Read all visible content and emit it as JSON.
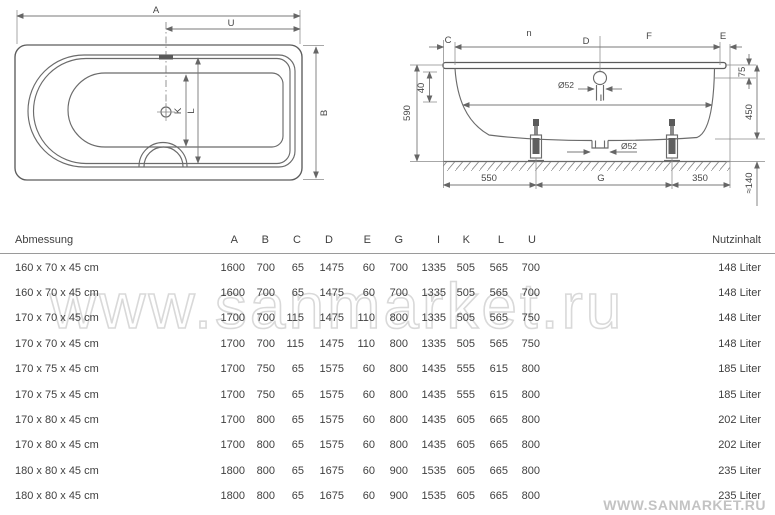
{
  "top_view": {
    "labels": {
      "length": "A",
      "overflow_to_end": "U",
      "width": "B",
      "inner_width": "K",
      "rim_inner_width": "L"
    }
  },
  "side_view": {
    "labels": {
      "left_overhang": "C",
      "upper_left": "n",
      "middle_span": "D",
      "upper_right": "F",
      "right_overhang": "E",
      "inner_length": "I",
      "feet_span": "G"
    },
    "fixed_dims": {
      "total_height": "590",
      "rim_drop": "40",
      "overflow_diameter": "Ø52",
      "drain_diameter": "Ø52",
      "rim_to_overflow": "75",
      "tub_depth": "450",
      "feet_height": "≈140",
      "foot_left_offset": "550",
      "foot_right_offset": "350"
    }
  },
  "table": {
    "header": {
      "dimension": "Abmessung",
      "capacity": "Nutzinhalt"
    },
    "columns": [
      "A",
      "B",
      "C",
      "D",
      "E",
      "G",
      "I",
      "K",
      "L",
      "U"
    ],
    "rows": [
      {
        "size": "160 x 70 x 45 cm",
        "values": [
          1600,
          700,
          65,
          1475,
          60,
          700,
          1335,
          505,
          565,
          700
        ],
        "capacity": "148 Liter"
      },
      {
        "size": "160 x 70 x 45 cm",
        "values": [
          1600,
          700,
          65,
          1475,
          60,
          700,
          1335,
          505,
          565,
          700
        ],
        "capacity": "148 Liter"
      },
      {
        "size": "170 x 70 x 45 cm",
        "values": [
          1700,
          700,
          115,
          1475,
          110,
          800,
          1335,
          505,
          565,
          750
        ],
        "capacity": "148 Liter"
      },
      {
        "size": "170 x 70 x 45 cm",
        "values": [
          1700,
          700,
          115,
          1475,
          110,
          800,
          1335,
          505,
          565,
          750
        ],
        "capacity": "148 Liter"
      },
      {
        "size": "170 x 75 x 45 cm",
        "values": [
          1700,
          750,
          65,
          1575,
          60,
          800,
          1435,
          555,
          615,
          800
        ],
        "capacity": "185 Liter"
      },
      {
        "size": "170 x 75 x 45 cm",
        "values": [
          1700,
          750,
          65,
          1575,
          60,
          800,
          1435,
          555,
          615,
          800
        ],
        "capacity": "185 Liter"
      },
      {
        "size": "170 x 80 x 45 cm",
        "values": [
          1700,
          800,
          65,
          1575,
          60,
          800,
          1435,
          605,
          665,
          800
        ],
        "capacity": "202 Liter"
      },
      {
        "size": "170 x 80 x 45 cm",
        "values": [
          1700,
          800,
          65,
          1575,
          60,
          800,
          1435,
          605,
          665,
          800
        ],
        "capacity": "202 Liter"
      },
      {
        "size": "180 x 80 x 45 cm",
        "values": [
          1800,
          800,
          65,
          1675,
          60,
          900,
          1535,
          605,
          665,
          800
        ],
        "capacity": "235 Liter"
      },
      {
        "size": "180 x 80 x 45 cm",
        "values": [
          1800,
          800,
          65,
          1675,
          60,
          900,
          1535,
          605,
          665,
          800
        ],
        "capacity": "235 Liter"
      }
    ]
  },
  "watermarks": {
    "center": "www.sanmarket.ru",
    "bottom_right": "WWW.SANMARKET.RU"
  }
}
